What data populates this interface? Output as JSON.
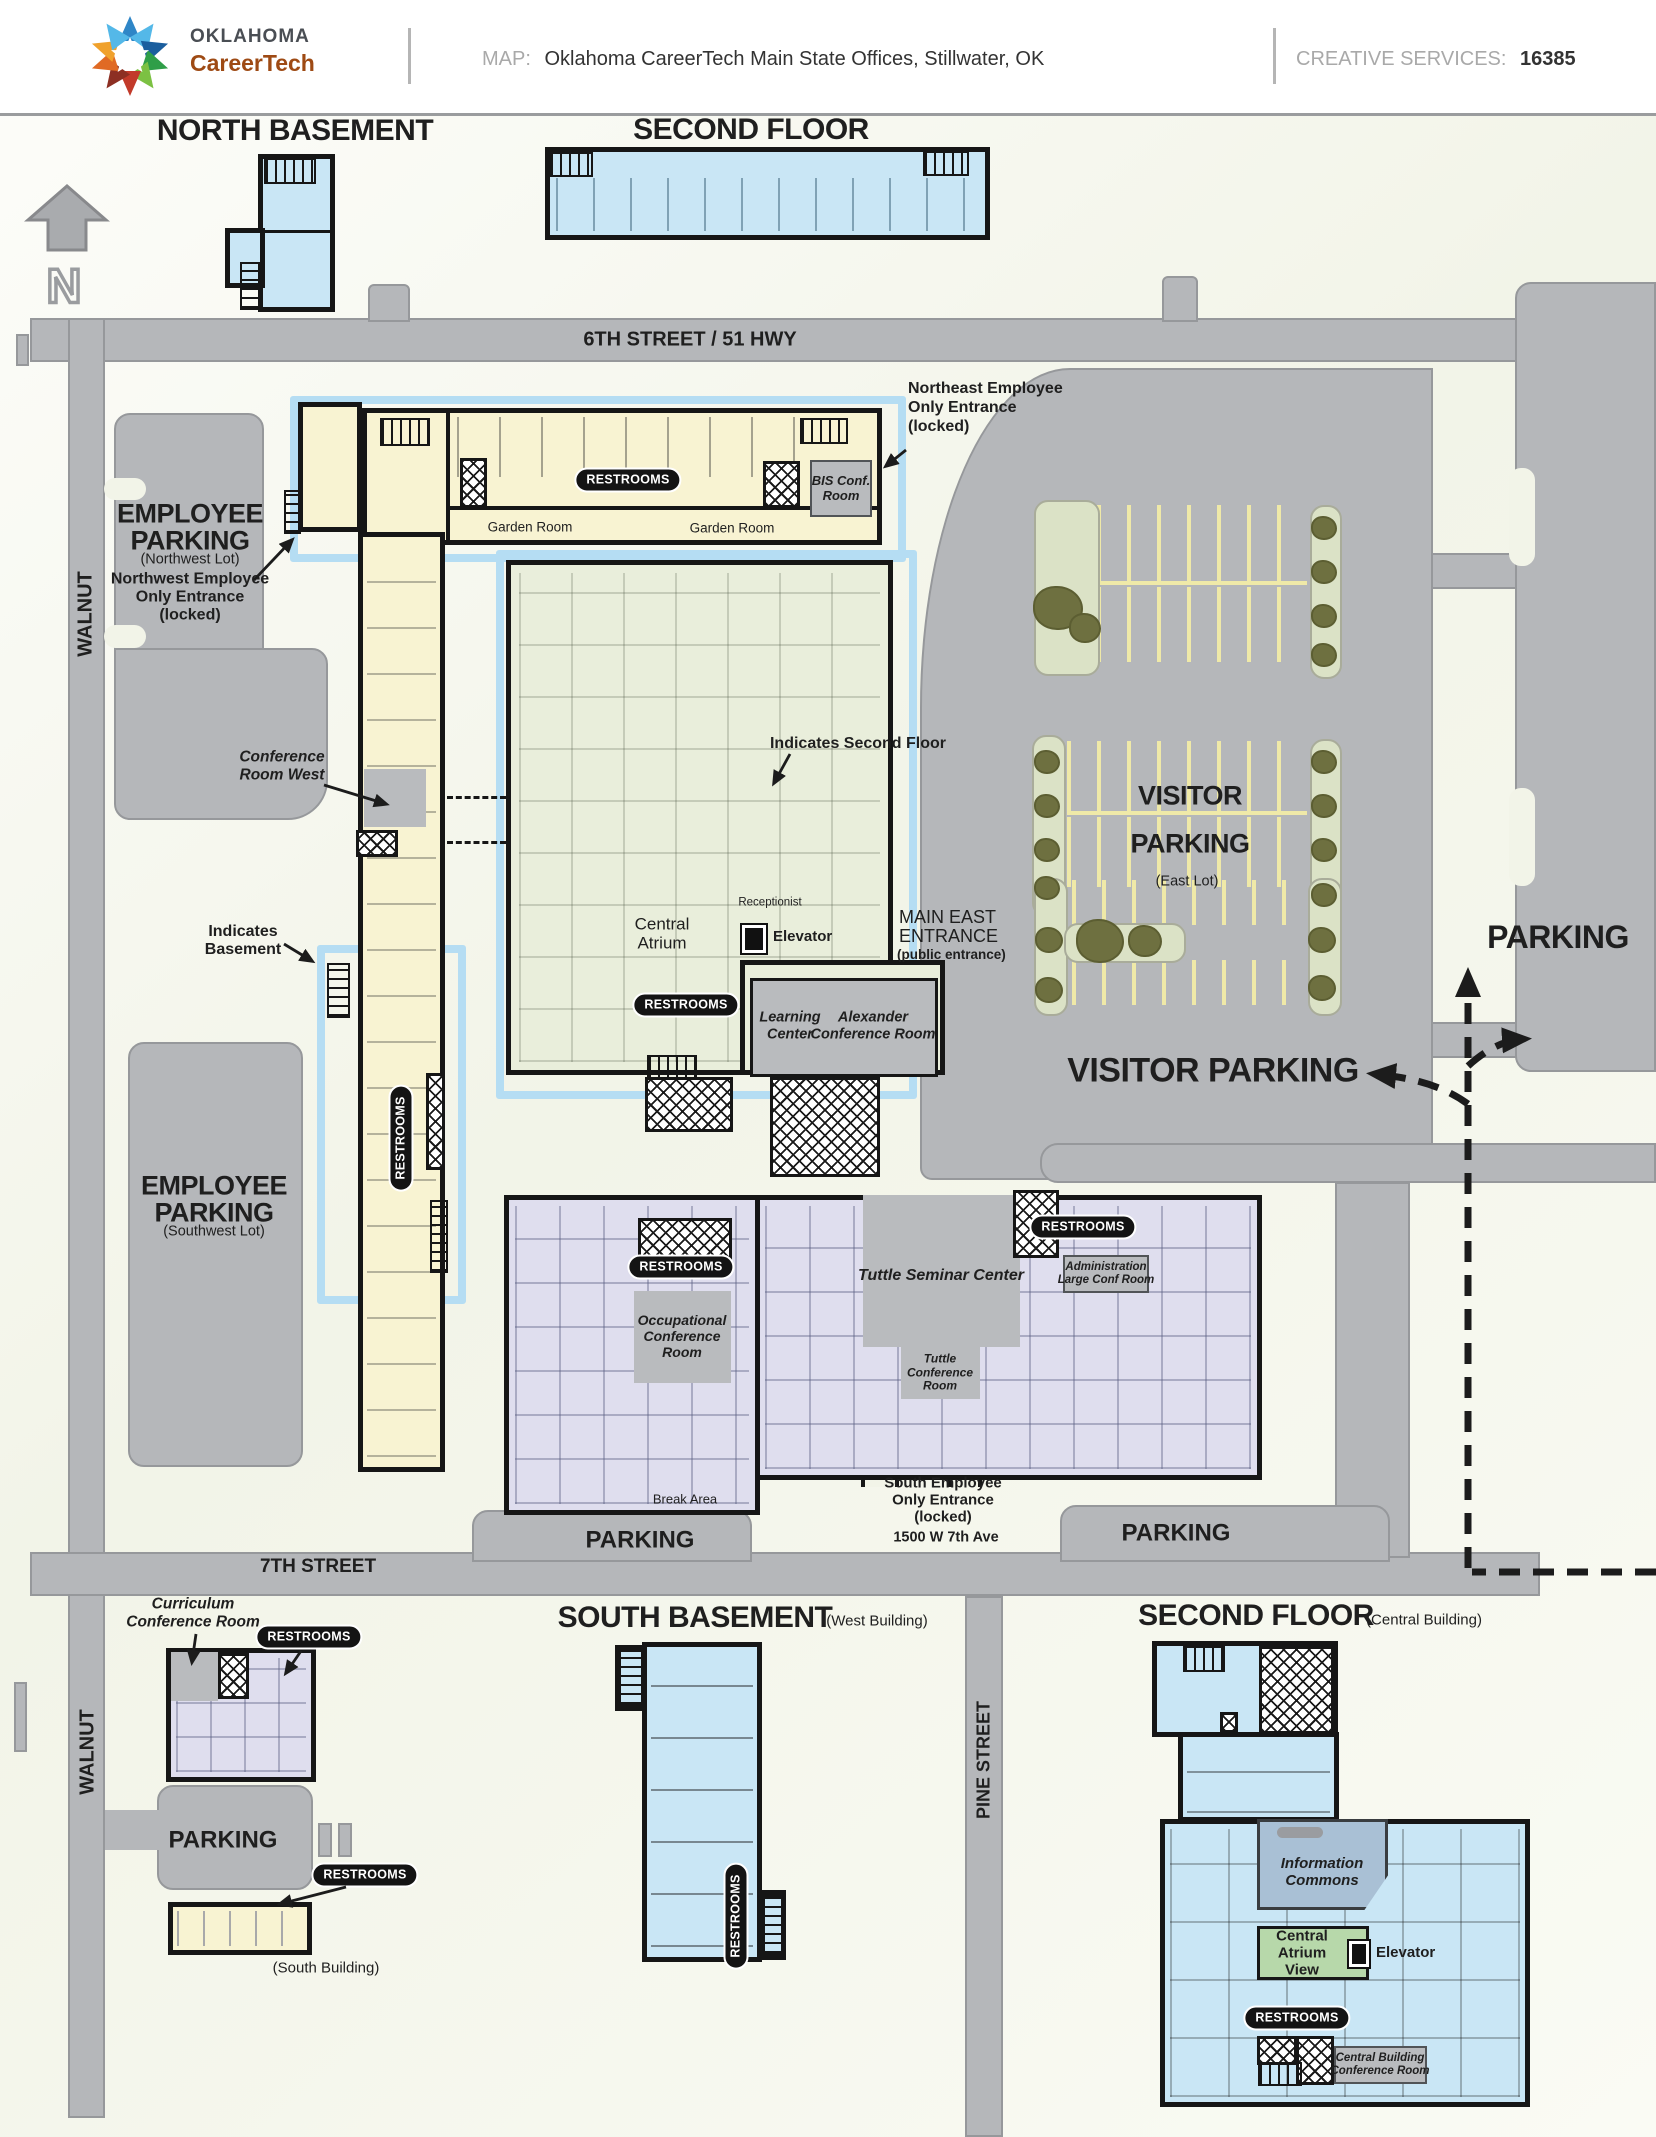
{
  "header": {
    "logo1": "OKLAHOMA",
    "logo2": "CareerTech",
    "map_label": "MAP:",
    "map_title": "Oklahoma CareerTech Main State Offices, Stillwater, OK",
    "cs_label": "CREATIVE SERVICES:",
    "cs_value": "16385"
  },
  "compass": {
    "n": "N"
  },
  "badge": {
    "restrooms": "RESTROOMS"
  },
  "title": {
    "north_basement": "NORTH BASEMENT",
    "second_floor": "SECOND FLOOR",
    "south_basement": "SOUTH BASEMENT",
    "south_basement_sub": "(West Building)",
    "second_floor_central": "SECOND FLOOR",
    "second_floor_central_sub": "(Central Building)"
  },
  "street": {
    "sixth": "6TH STREET / 51 HWY",
    "seventh": "7TH STREET",
    "walnut": "WALNUT",
    "pine": "PINE STREET"
  },
  "lot": {
    "nw": {
      "l1": "EMPLOYEE",
      "l2": "PARKING",
      "sub": "(Northwest Lot)"
    },
    "sw": {
      "l1": "EMPLOYEE",
      "l2": "PARKING",
      "sub": "(Southwest Lot)"
    },
    "east": {
      "l1": "VISITOR",
      "l2": "PARKING",
      "sub": "(East Lot)"
    },
    "parking_east": "PARKING",
    "visitor_route": "VISITOR PARKING",
    "parking_7l": "PARKING",
    "parking_7r": "PARKING",
    "parking_s": "PARKING"
  },
  "note": {
    "ne": "Northeast Employee\nOnly Entrance\n(locked)",
    "nw": "Northwest Employee\nOnly Entrance\n(locked)",
    "crw": "Conference\nRoom West",
    "isf": "Indicates Second Floor",
    "ib": "Indicates\nBasement",
    "se": "South Employee\nOnly Entrance\n(locked)",
    "addr": "1500 W 7th Ave",
    "curr": "Curriculum\nConference Room",
    "sb_sub": "(South Building)"
  },
  "room": {
    "garden1": "Garden Room",
    "garden2": "Garden Room",
    "bis": "BIS Conf.\nRoom",
    "recept": "Receptionist",
    "atrium": "Central\nAtrium",
    "elev1": "Elevator",
    "elev2": "Elevator",
    "main_east": "MAIN EAST\nENTRANCE",
    "main_east_sub": "(public entrance)",
    "learning": "Learning\nCenter",
    "alexander": "Alexander\nConference Room",
    "occupational": "Occupational\nConference\nRoom",
    "tuttle_sem": "Tuttle Seminar Center",
    "tuttle_conf": "Tuttle\nConference\nRoom",
    "admin": "Administration\nLarge Conf Room",
    "brk": "Break Area",
    "info": "Information\nCommons",
    "atrium_view": "Central\nAtrium\nView",
    "cbcr": "Central Building\nConference Room"
  }
}
